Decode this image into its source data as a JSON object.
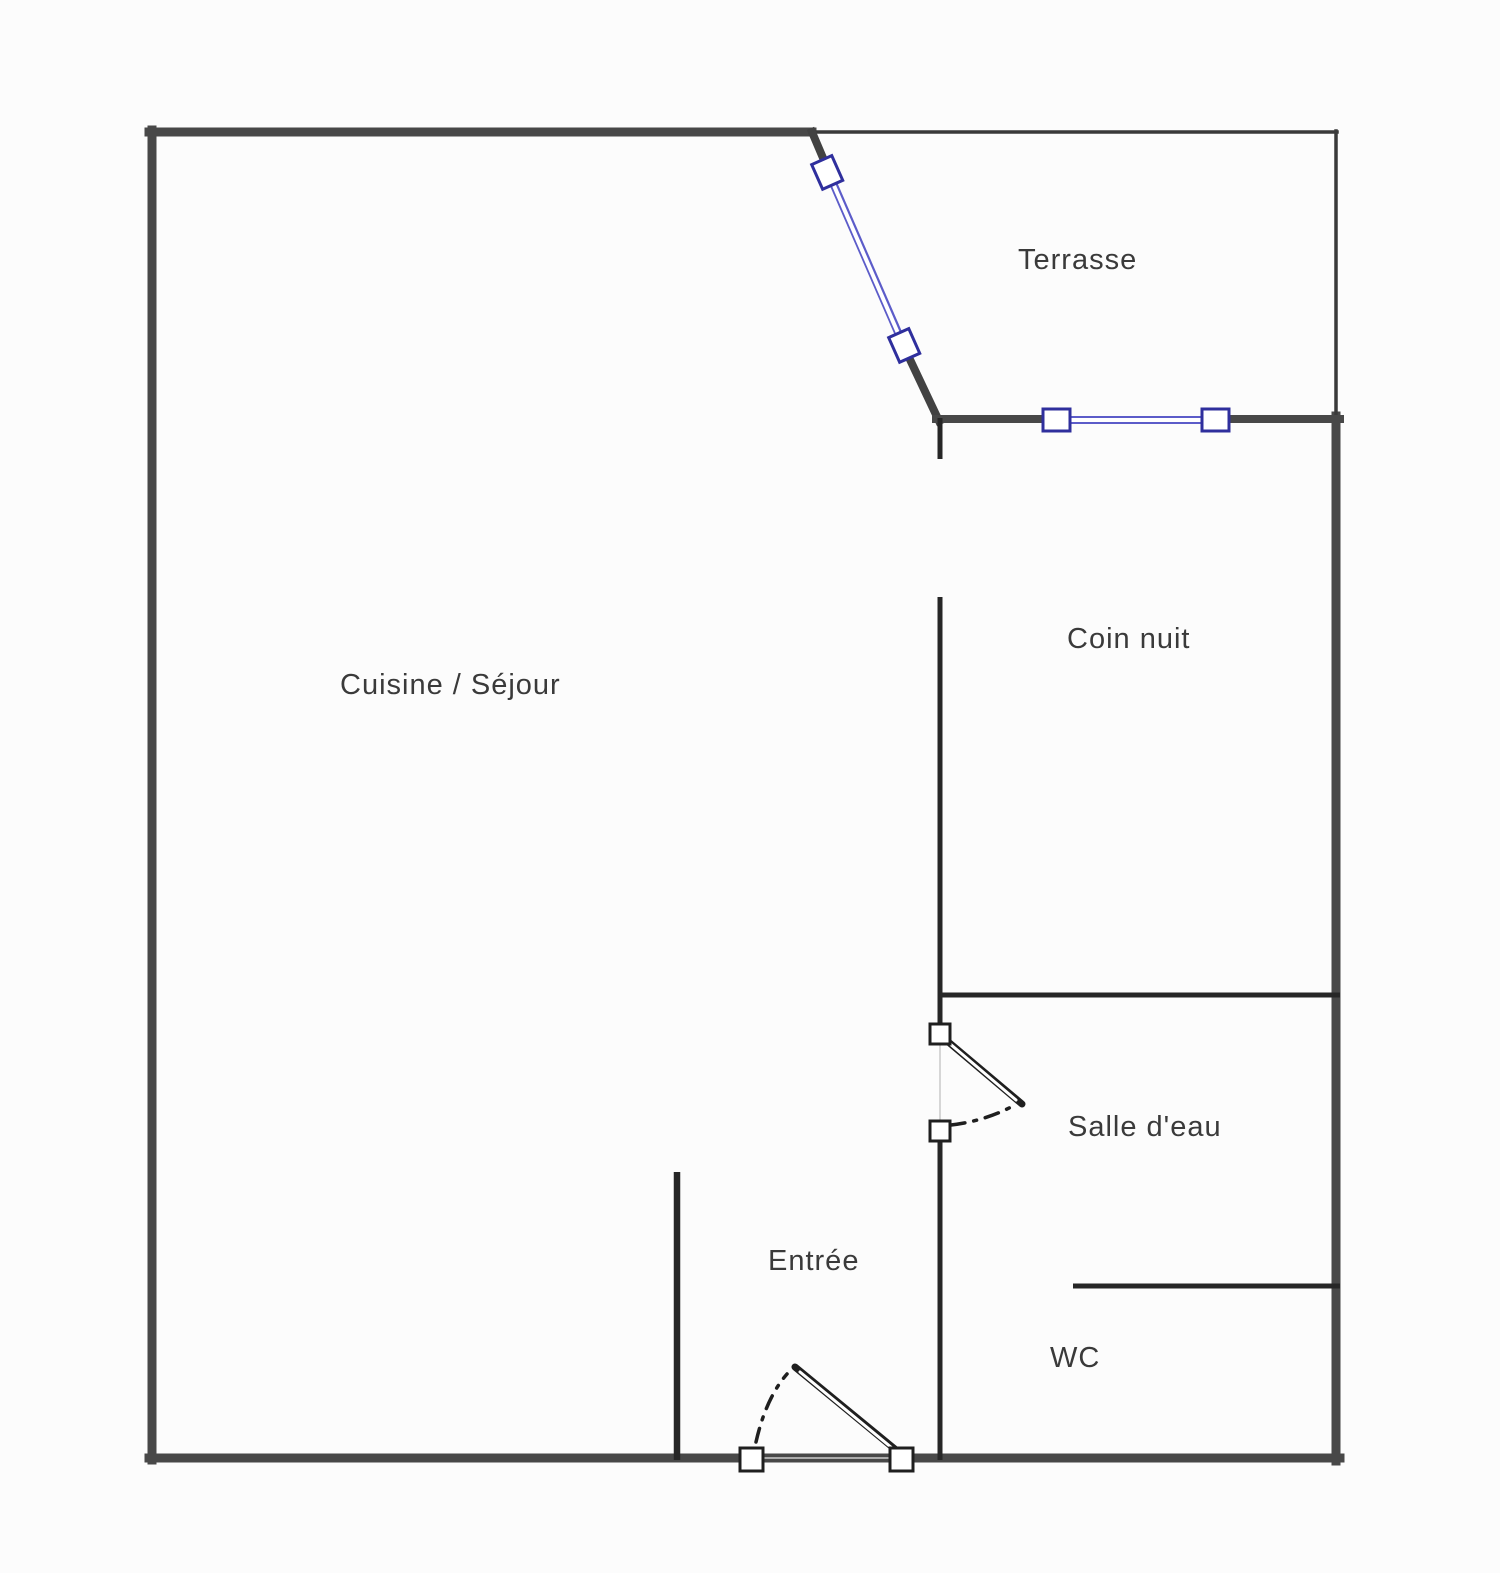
{
  "rooms": [
    {
      "id": "terrasse",
      "label": "Terrasse"
    },
    {
      "id": "cuisine-sejour",
      "label": "Cuisine / Séjour"
    },
    {
      "id": "coin-nuit",
      "label": "Coin nuit"
    },
    {
      "id": "salle-eau",
      "label": "Salle d'eau"
    },
    {
      "id": "entree",
      "label": "Entrée"
    },
    {
      "id": "wc",
      "label": "WC"
    }
  ],
  "colors": {
    "background": "#fcfcfc",
    "outer_wall": "#484848",
    "thin_wall": "#3a3a3a",
    "inner_wall": "#262626",
    "window_blue": "#5c5cc9",
    "window_frame": "#2f2f9d",
    "door_color": "#1f1f1f",
    "faint_line": "#cccccc",
    "label_text": "#3a3a3a"
  }
}
